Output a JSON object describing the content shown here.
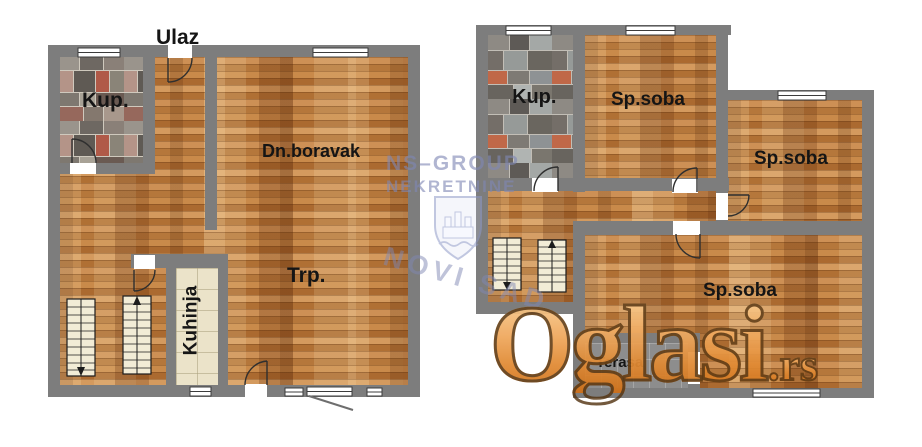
{
  "plan_left": {
    "entrance": "Ulaz",
    "rooms": {
      "bathroom": "Kup.",
      "living": "Dn.boravak",
      "dining": "Trp.",
      "kitchen": "Kuhinja"
    }
  },
  "plan_right": {
    "rooms": {
      "bathroom": "Kup.",
      "bedroom_top": "Sp.soba",
      "bedroom_right": "Sp.soba",
      "bedroom_main": "Sp.soba",
      "terrace": "Terasa"
    }
  },
  "watermarks": {
    "agency": {
      "line1": "NS–GROUP",
      "line2": "NEKRETNINE",
      "city": "NOVI SAD"
    },
    "site": {
      "name": "Oglasi",
      "tld": ".rs"
    }
  },
  "colors": {
    "wall": "#7d7d7d",
    "wood_floor": "#c2824a",
    "kitchen_floor": "#ebe3c9",
    "terrace_floor": "#8d8d8d",
    "stair_fill": "#f2ecd6",
    "agency_watermark": "#8088b4",
    "site_orange": "#e18a33",
    "label_text": "#151515"
  }
}
